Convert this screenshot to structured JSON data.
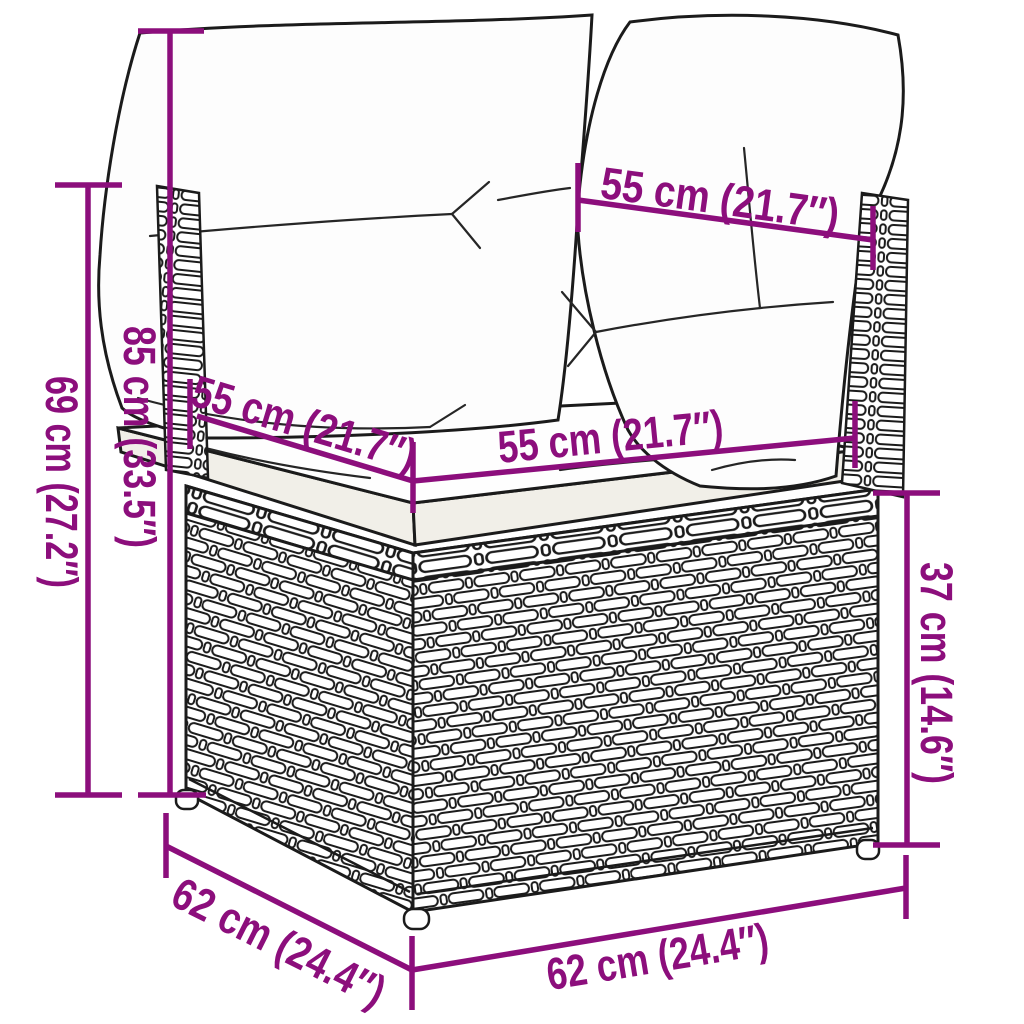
{
  "diagram": {
    "kind": "product dimension diagram",
    "product": "poly rattan corner sofa section with back and seat cushions",
    "unit_system": "cm (inches)",
    "colors": {
      "accent": "#8C0E7C",
      "outline": "#1B1B1B",
      "background": "#FFFFFF",
      "cushion": "#FFFFFF"
    },
    "dims": [
      {
        "id": "back-cushion-width",
        "cm": 55,
        "in": 21.7,
        "label": "55 cm (21.7″)"
      },
      {
        "id": "seat-depth",
        "cm": 55,
        "in": 21.7,
        "label": "55 cm (21.7″)"
      },
      {
        "id": "seat-width",
        "cm": 55,
        "in": 21.7,
        "label": "55 cm (21.7″)"
      },
      {
        "id": "total-height",
        "cm": 85,
        "in": 33.5,
        "label": "85 cm (33.5″)"
      },
      {
        "id": "backrest-height",
        "cm": 69,
        "in": 27.2,
        "label": "69 cm (27.2″)"
      },
      {
        "id": "base-height",
        "cm": 37,
        "in": 14.6,
        "label": "37 cm (14.6″)"
      },
      {
        "id": "base-depth",
        "cm": 62,
        "in": 24.4,
        "label": "62 cm (24.4″)"
      },
      {
        "id": "base-width",
        "cm": 62,
        "in": 24.4,
        "label": "62 cm (24.4″)"
      }
    ]
  }
}
